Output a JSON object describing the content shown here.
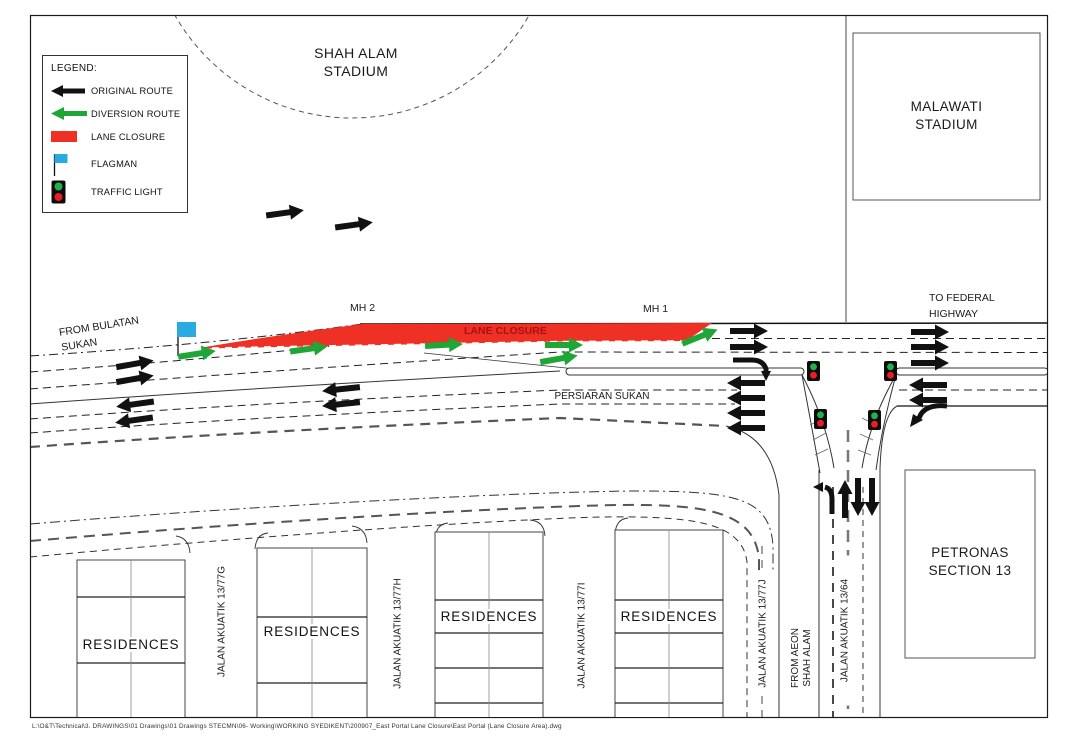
{
  "legend": {
    "title": "LEGEND:",
    "items": [
      {
        "label": "ORIGINAL ROUTE"
      },
      {
        "label": "DIVERSION ROUTE"
      },
      {
        "label": "LANE CLOSURE"
      },
      {
        "label": "FLAGMAN"
      },
      {
        "label": "TRAFFIC LIGHT"
      }
    ]
  },
  "places": {
    "shah_alam_stadium": {
      "line1": "SHAH ALAM",
      "line2": "STADIUM"
    },
    "malawati_stadium": {
      "line1": "MALAWATI",
      "line2": "STADIUM"
    },
    "petronas": {
      "line1": "PETRONAS",
      "line2": "SECTION 13"
    },
    "residences": "RESIDENCES"
  },
  "roads": {
    "persiaran_sukan": "PERSIARAN SUKAN",
    "from_bulatan_sukan": {
      "line1": "FROM BULATAN",
      "line2": "SUKAN"
    },
    "to_federal_highway": {
      "line1": "TO FEDERAL",
      "line2": "HIGHWAY"
    },
    "lane_closure_label": "LANE CLOSURE",
    "mh1": "MH 1",
    "mh2": "MH 2",
    "streets": [
      {
        "label": "JALAN AKUATIK 13/77G"
      },
      {
        "label": "JALAN AKUATIK 13/77H"
      },
      {
        "label": "JALAN AKUATIK 13/77I"
      },
      {
        "label": "JALAN AKUATIK 13/77J"
      },
      {
        "label": "FROM AEON",
        "label2": "SHAH ALAM"
      },
      {
        "label": "JALAN AKUATIK 13/64"
      }
    ]
  },
  "colors": {
    "closure_red": "#ee3124",
    "diversion_green": "#1fa637",
    "flag_blue": "#29abe2",
    "signal_green": "#22b14c",
    "signal_red": "#ed1c24"
  },
  "document": {
    "footer_path": "L:\\O&T\\Technical\\3. DRAWINGS\\01 Drawings\\01 Drawings STECMN\\06- Working\\WORKING SYEDIKENT\\200907_East Portal Lane Closure\\East Portal (Lane Closure Area).dwg"
  }
}
